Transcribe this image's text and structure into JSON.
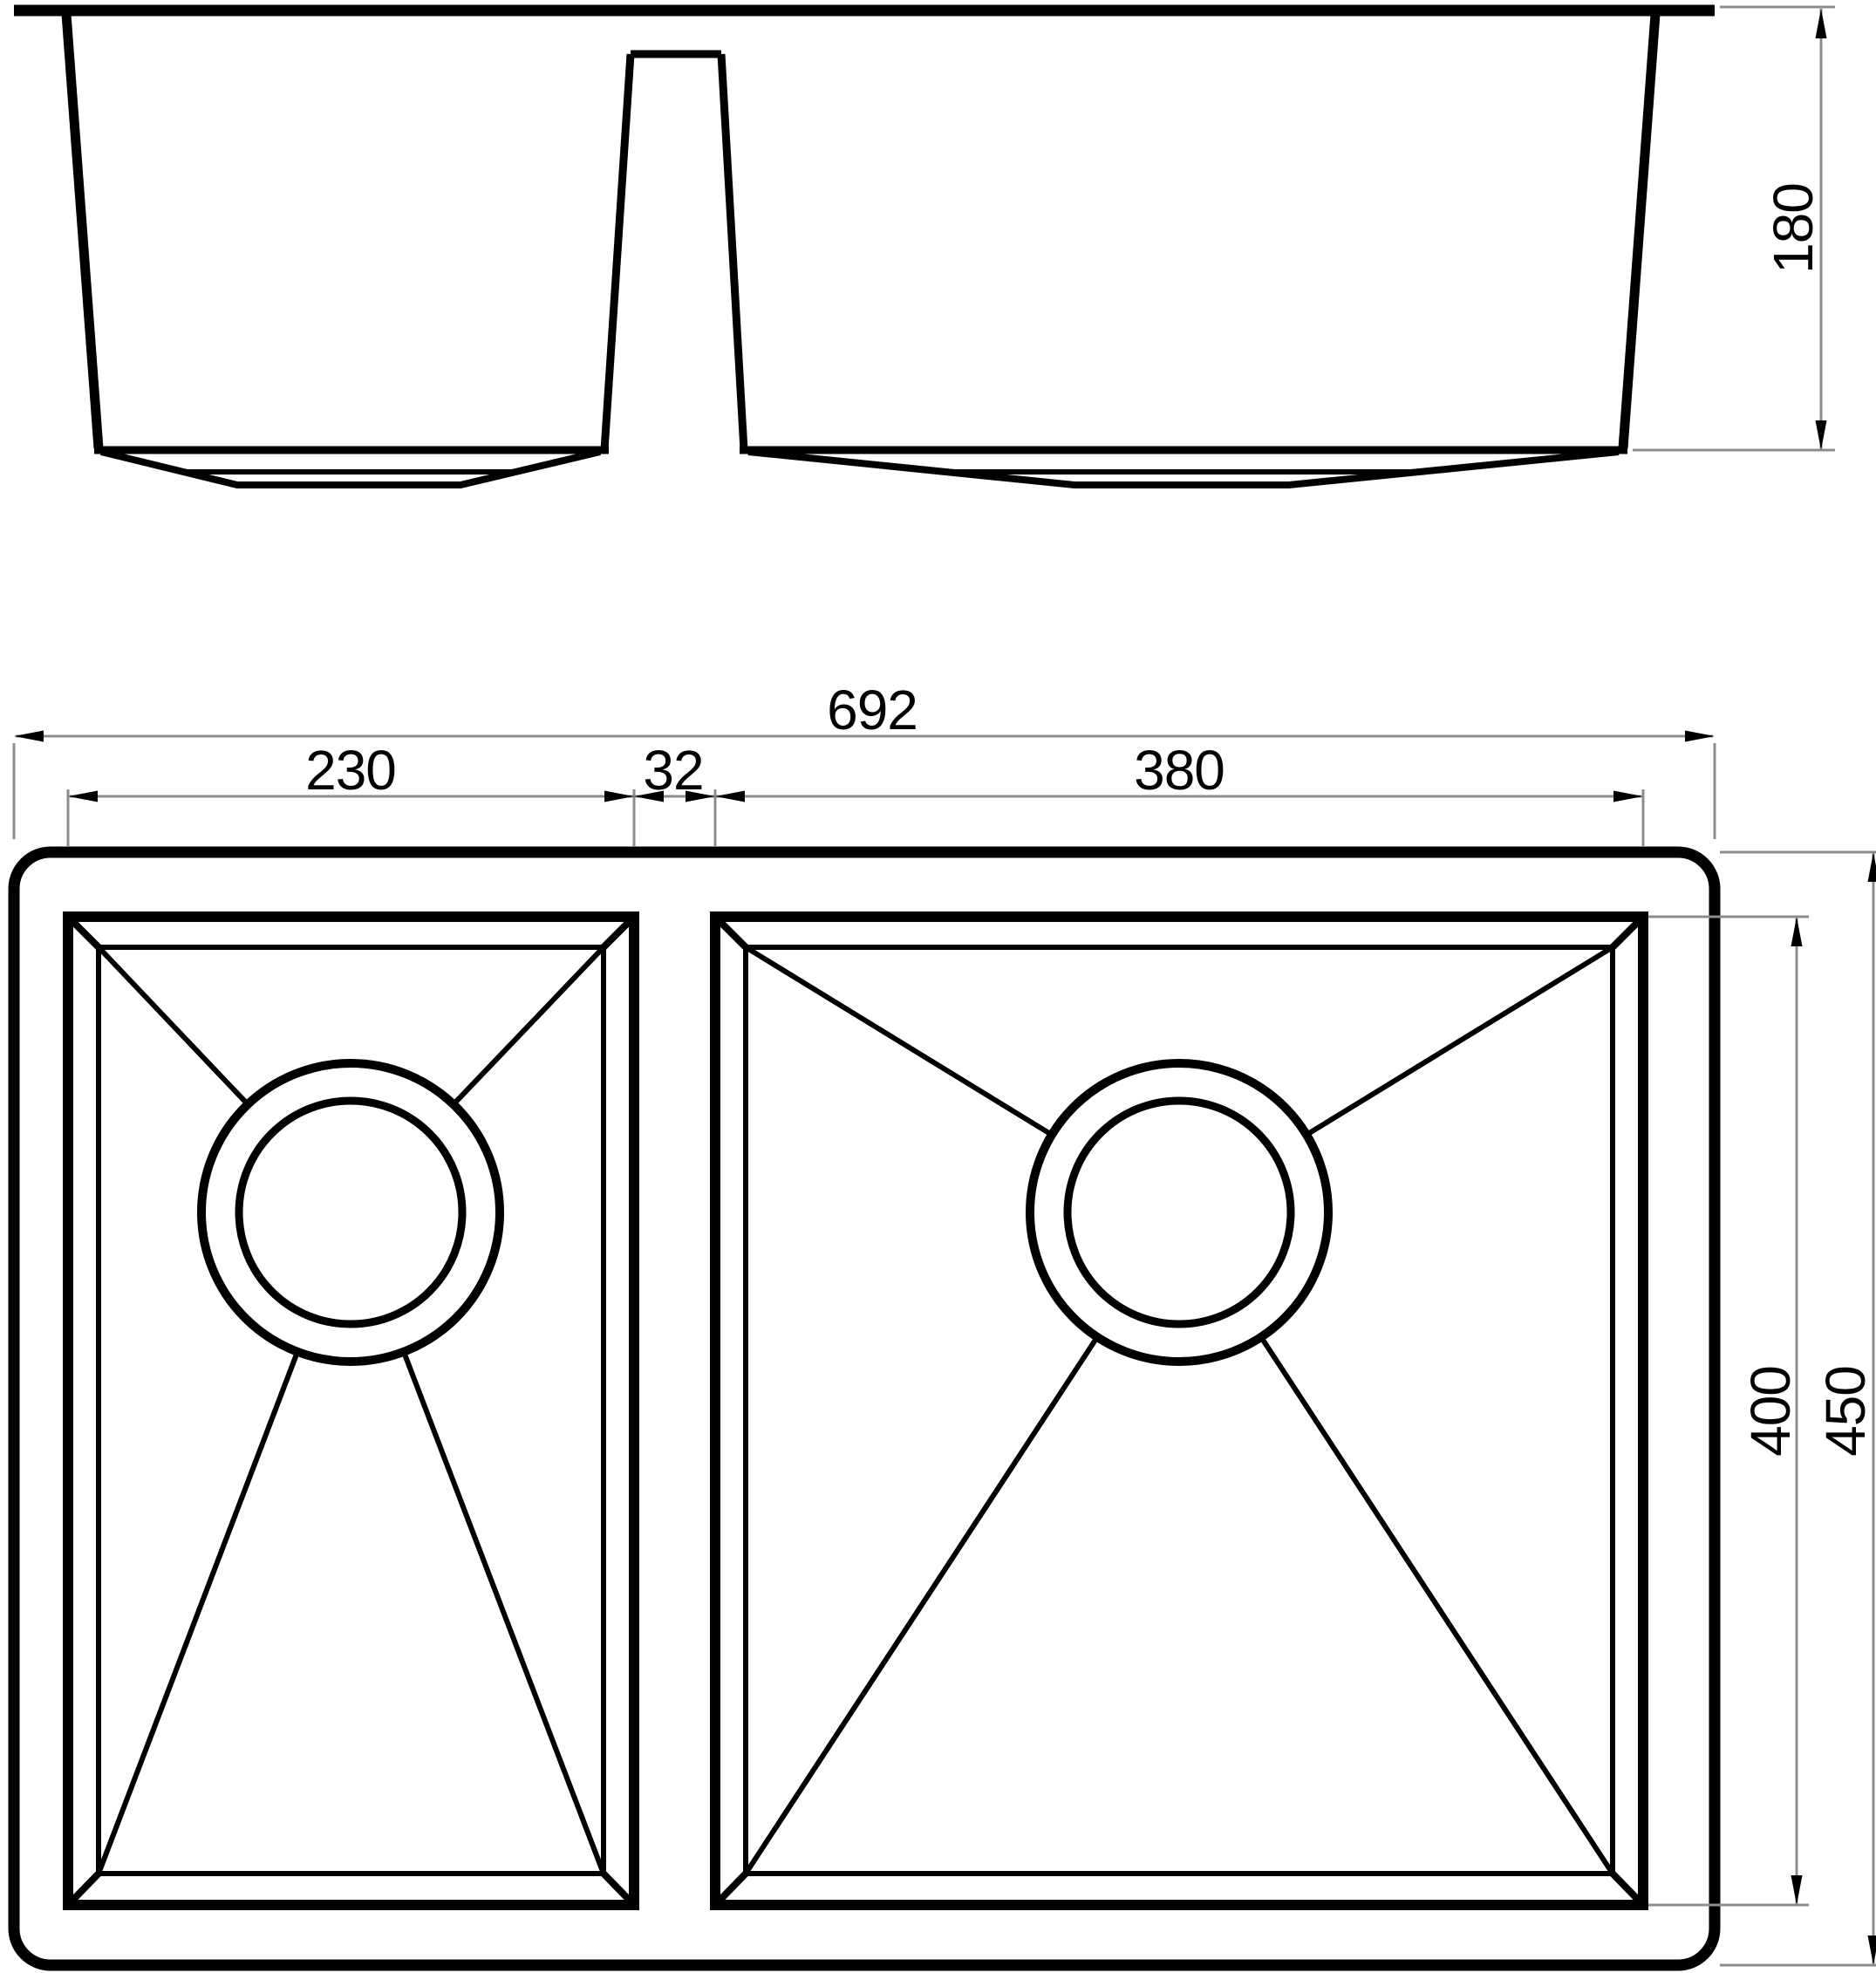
{
  "drawing": {
    "type": "technical-dimension-drawing",
    "subject": "double-bowl-undermount-kitchen-sink",
    "background": "#ffffff",
    "line_color": "#000000",
    "dimension_color": "#8c8c8c",
    "front_view": {
      "bowl_depth": "180"
    },
    "plan_view": {
      "overall_width": "692",
      "left_bowl_width": "230",
      "divider_width": "32",
      "right_bowl_width": "380",
      "bowl_front_to_back": "400",
      "overall_front_to_back": "450"
    }
  }
}
